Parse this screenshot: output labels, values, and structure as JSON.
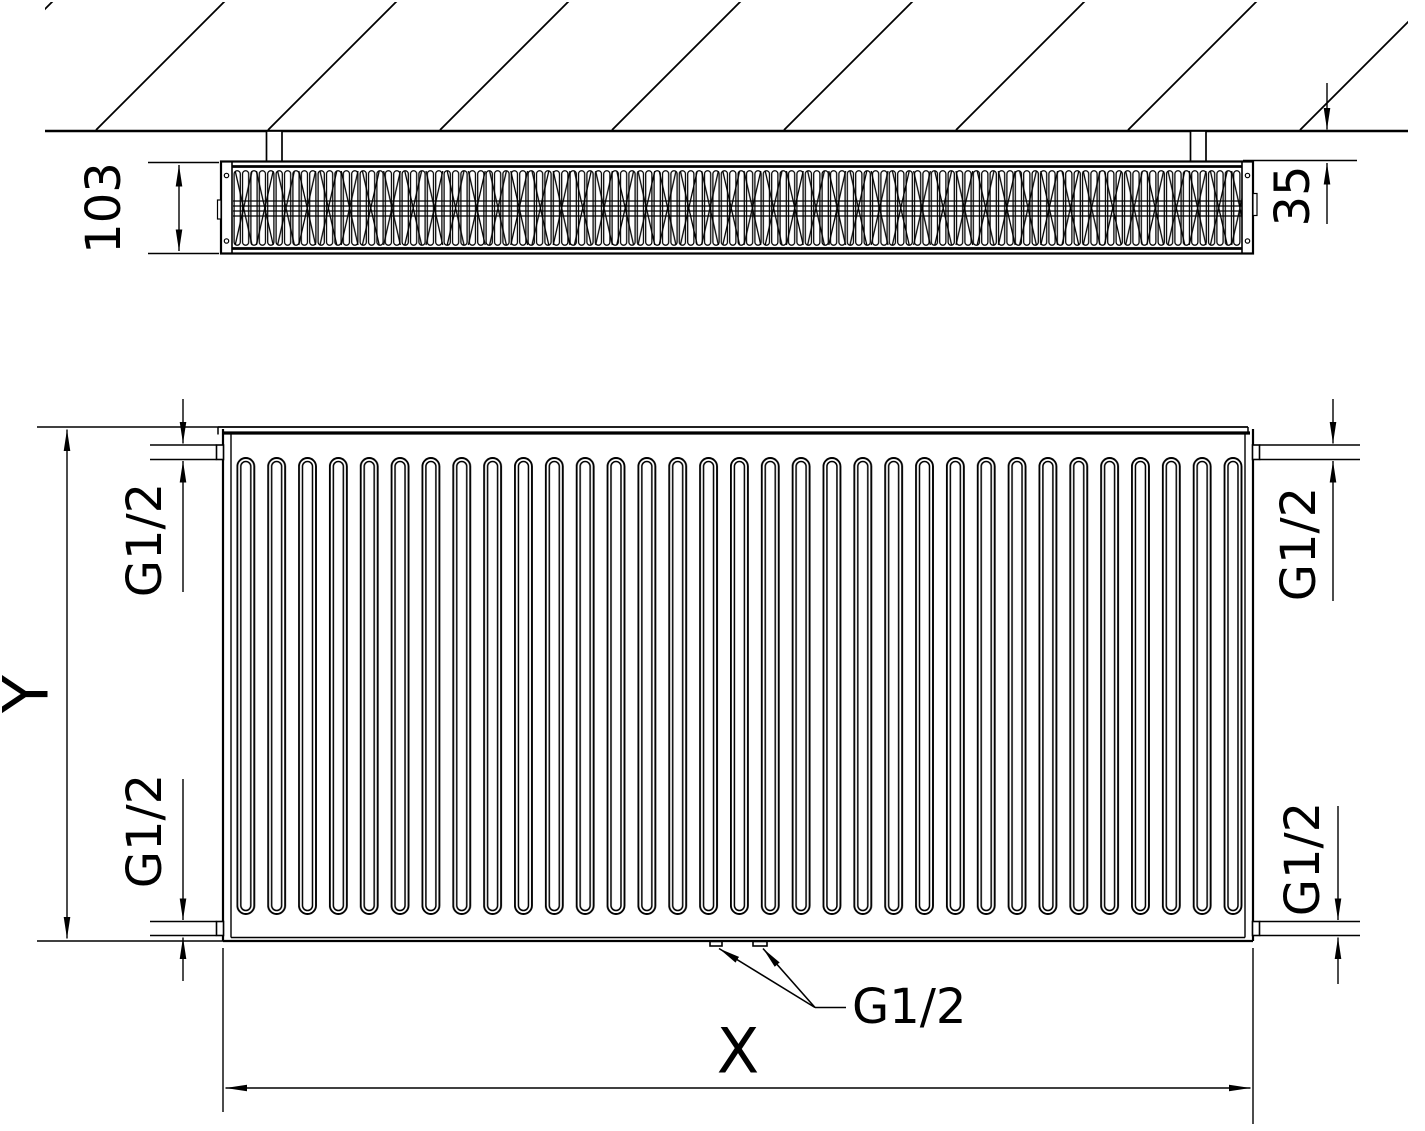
{
  "drawing": {
    "type": "radiator technical drawing, side section with wall and front view",
    "colors": {
      "line": "#000000",
      "background": "#ffffff",
      "text": "#000000"
    },
    "top_view": {
      "depth_dimension": "103",
      "wall_clearance_dimension": "35"
    },
    "front_view": {
      "height_dimension": "Y",
      "length_dimension": "X",
      "connection_top_left": "G1/2",
      "connection_bottom_left": "G1/2",
      "connection_top_right": "G1/2",
      "connection_bottom_right": "G1/2",
      "connection_bottom_center": "G1/2"
    }
  }
}
